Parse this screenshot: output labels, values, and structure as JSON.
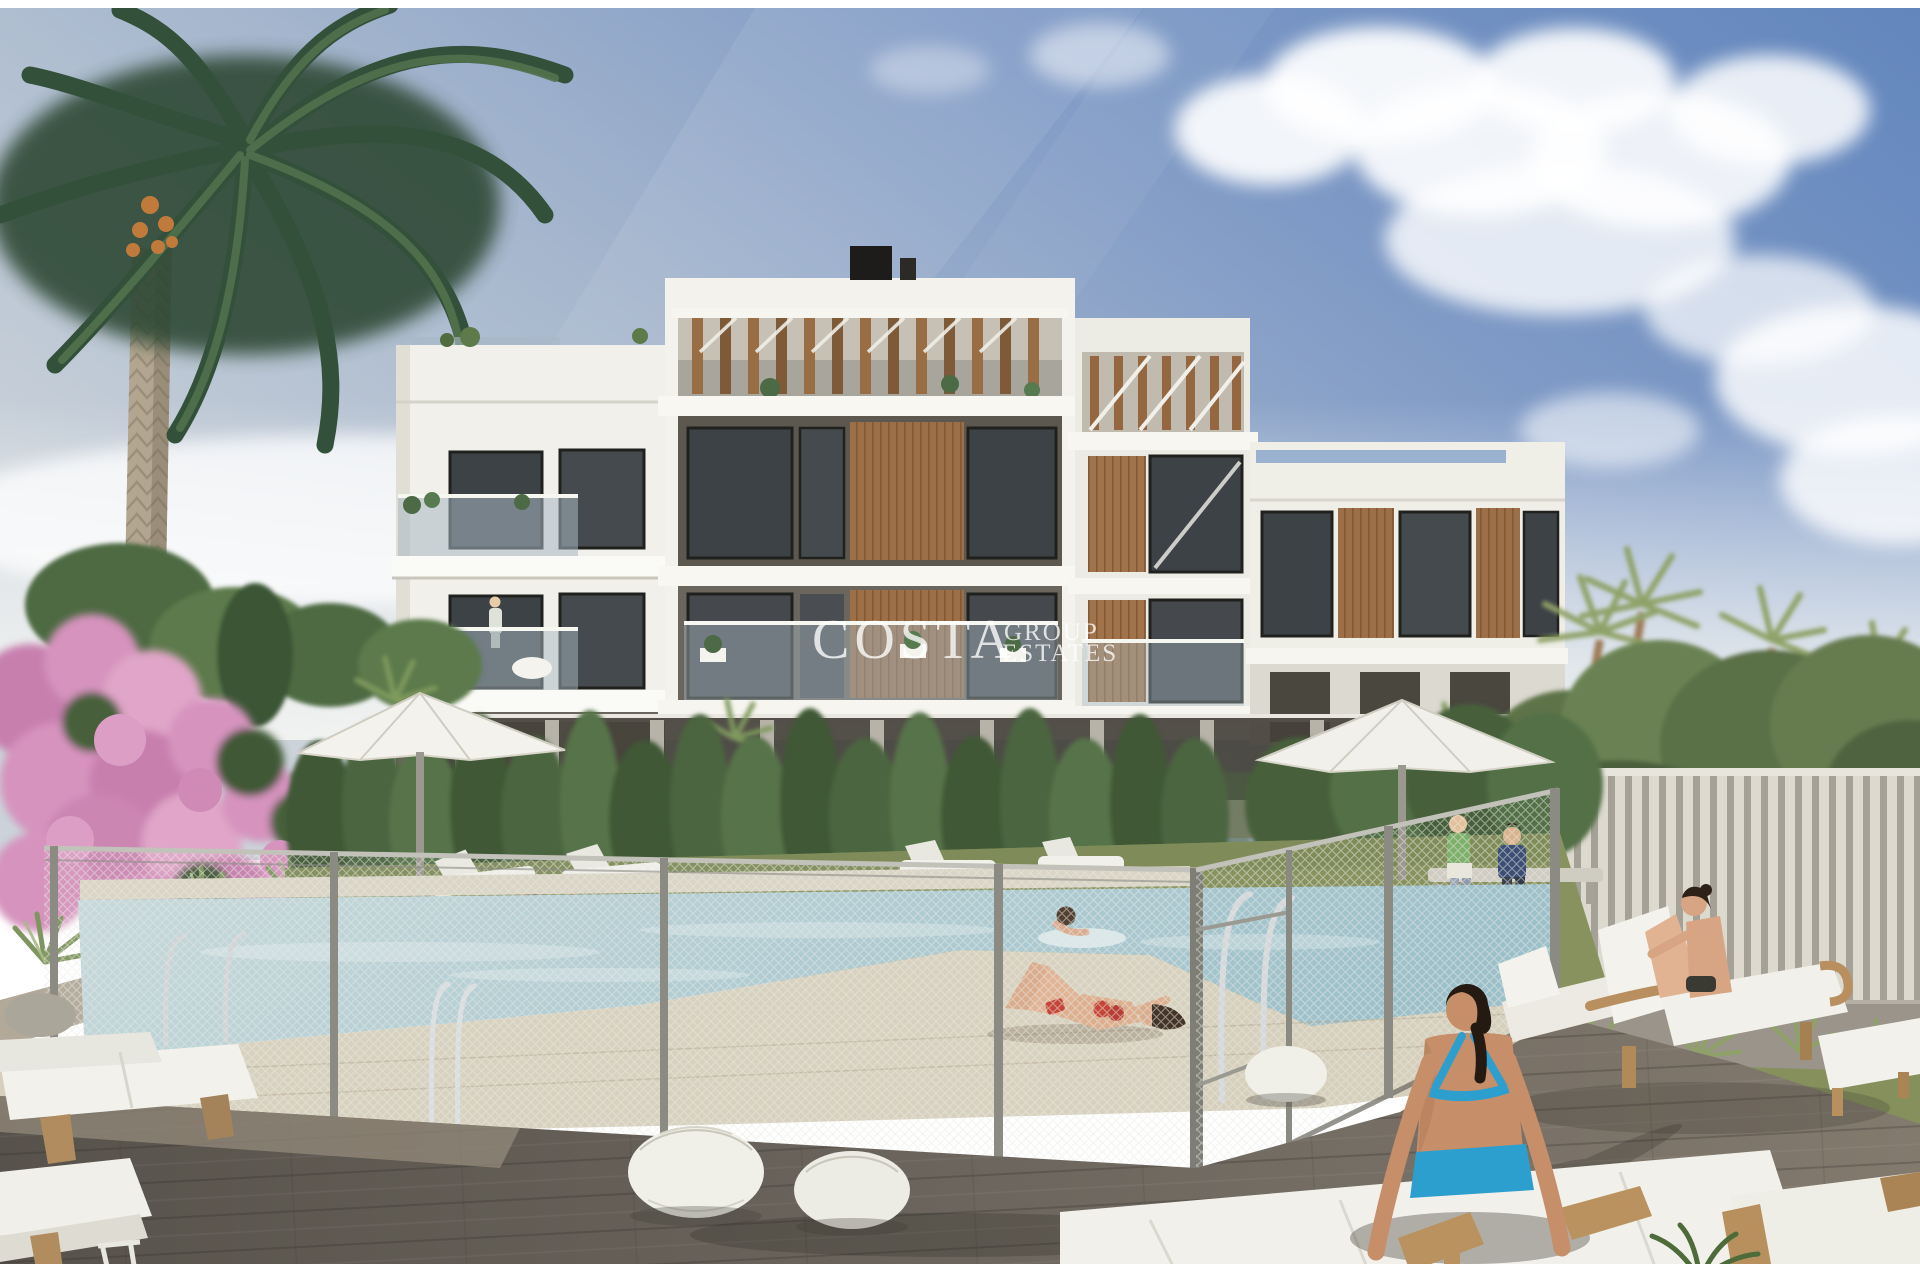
{
  "image": {
    "alt": "Architectural render of a modern white apartment complex with rooftop pergolas, a fenced swimming pool, sun loungers, umbrellas, palm trees and people relaxing on a grey wooden deck"
  },
  "watermark": {
    "line1": "COSTA",
    "line2": "GROUP",
    "line3": "ESTATES",
    "color": "#ffffff",
    "opacity": "0.78"
  },
  "palette": {
    "sky_deep_blue": "#6286bd",
    "sky_pale": "#ccd3da",
    "cloud_white": "#ffffff",
    "building_white": "#f2f1eb",
    "building_recess": "#5c584f",
    "window_glass": "#3d4247",
    "wood_slats": "#9c6f49",
    "pergola_wood": "#9a6e44",
    "balcony_glass": "#a8b8c1",
    "pool_water": "#aecbd2",
    "pool_deck_beige": "#d6cfbc",
    "grass_green": "#87925f",
    "hedge_green": "#4b6540",
    "palm_green": "#33503a",
    "bougainvillea_pink": "#d593bd",
    "mesh_fence": "#e8e8e2",
    "slat_fence": "#dcd9cf",
    "deck_grey": "#6b655d",
    "skin_tan": "#d0996f",
    "bikini_turquoise": "#2d9fce",
    "bikini_red": "#c23b2e",
    "lounger_cushion": "#f1f0ea",
    "lounger_wood": "#b08c5e"
  }
}
